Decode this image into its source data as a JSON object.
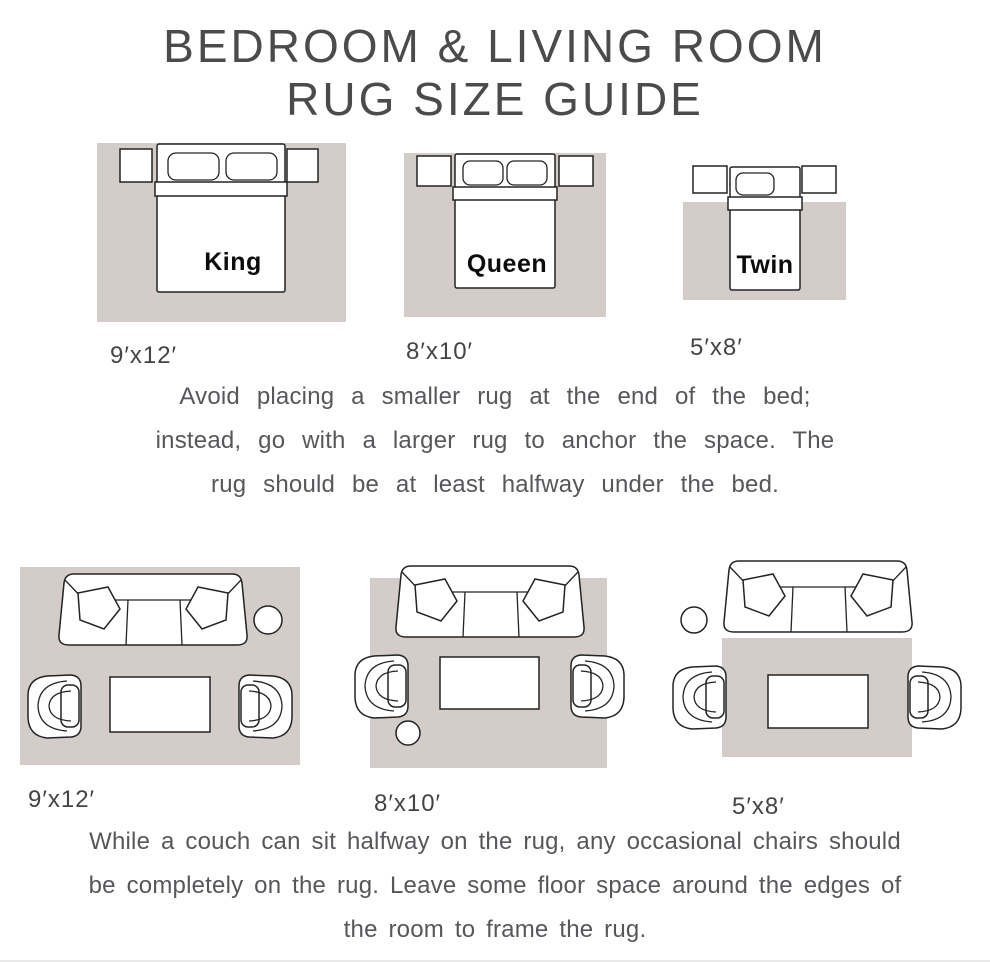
{
  "title": {
    "line1": "BEDROOM & LIVING ROOM",
    "line2": "RUG SIZE GUIDE"
  },
  "colors": {
    "rug": "#d3ccc8",
    "outline": "#232323",
    "title_text": "#4b4b4d",
    "body_text": "#56575a",
    "size_label_text": "#434446",
    "bed_label_text": "#0c0c0c",
    "background": "#ffffff"
  },
  "bedroom_section": {
    "diagrams": [
      {
        "bed_label": "King",
        "rug_size": "9′x12′"
      },
      {
        "bed_label": "Queen",
        "rug_size": "8′x10′"
      },
      {
        "bed_label": "Twin",
        "rug_size": "5′x8′"
      }
    ],
    "note": {
      "line1": "Avoid placing a smaller rug at the end of the bed;",
      "line2": "instead, go with a larger rug to anchor the space. The",
      "line3": "rug should be at least halfway under the bed."
    }
  },
  "living_section": {
    "diagrams": [
      {
        "rug_size": "9′x12′"
      },
      {
        "rug_size": "8′x10′"
      },
      {
        "rug_size": "5′x8′"
      }
    ],
    "note": {
      "line1": "While a couch can sit halfway on the rug, any occasional chairs should",
      "line2": "be completely on the rug. Leave some floor space around the edges of",
      "line3": "the room to frame the rug."
    }
  }
}
